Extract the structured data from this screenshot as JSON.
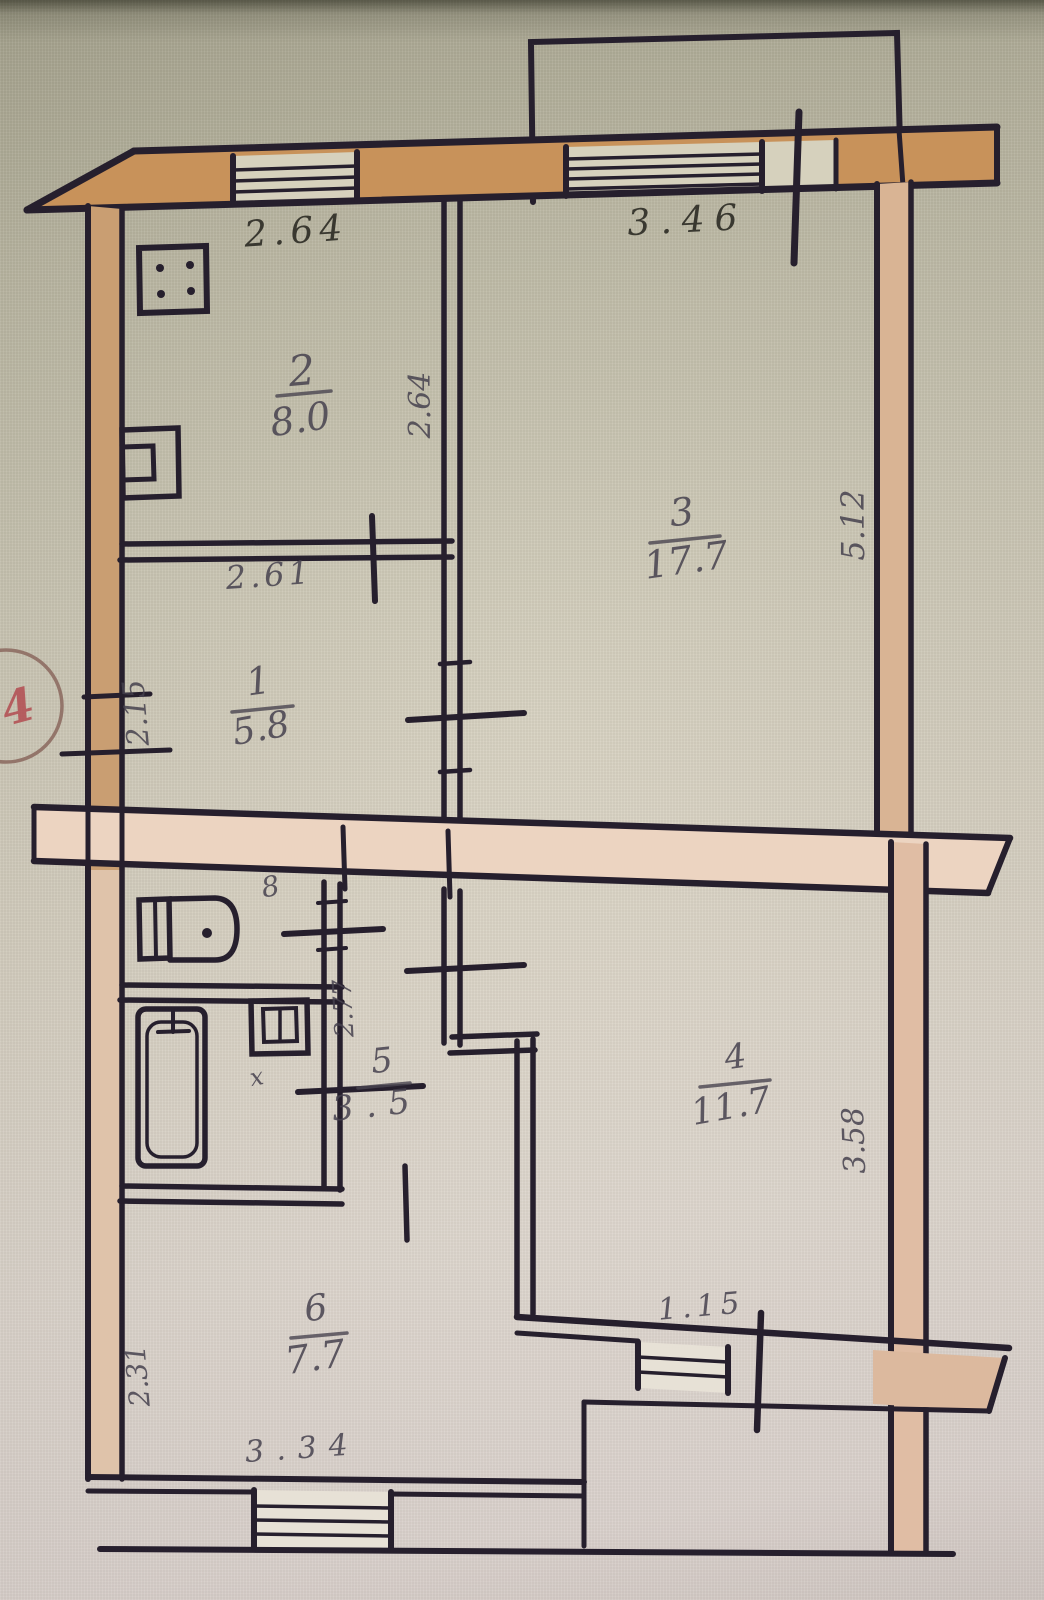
{
  "plan": {
    "stamp": "4",
    "rooms": [
      {
        "number": "1",
        "area": "5.8"
      },
      {
        "number": "2",
        "area": "8.0"
      },
      {
        "number": "3",
        "area": "17.7"
      },
      {
        "number": "4",
        "area": "11.7"
      },
      {
        "number": "5",
        "area": "3.5"
      },
      {
        "number": "6",
        "area": "7.7"
      }
    ],
    "dims": {
      "top_left": "2.64",
      "top_right": "3.46",
      "room2_right_wall": "2.64",
      "room1_top": "2.61",
      "right_wall_upper": "5.12",
      "left_wall_hall": "2.15",
      "wc_door": "8",
      "corridor_wall": "2.77",
      "bath_mark": "x",
      "right_wall_lower": "3.58",
      "room6_left": "2.31",
      "room6_bottom": "3.34",
      "balcony_door": "1.15"
    },
    "colors": {
      "ink": "#261f2d",
      "wall_fill": "#c8925a",
      "left_wall_fill": "#c99e72",
      "right_wall_fill": "#d9b494",
      "slab_fill": "#ecd4c1",
      "stamp_red": "#b0444a"
    }
  }
}
